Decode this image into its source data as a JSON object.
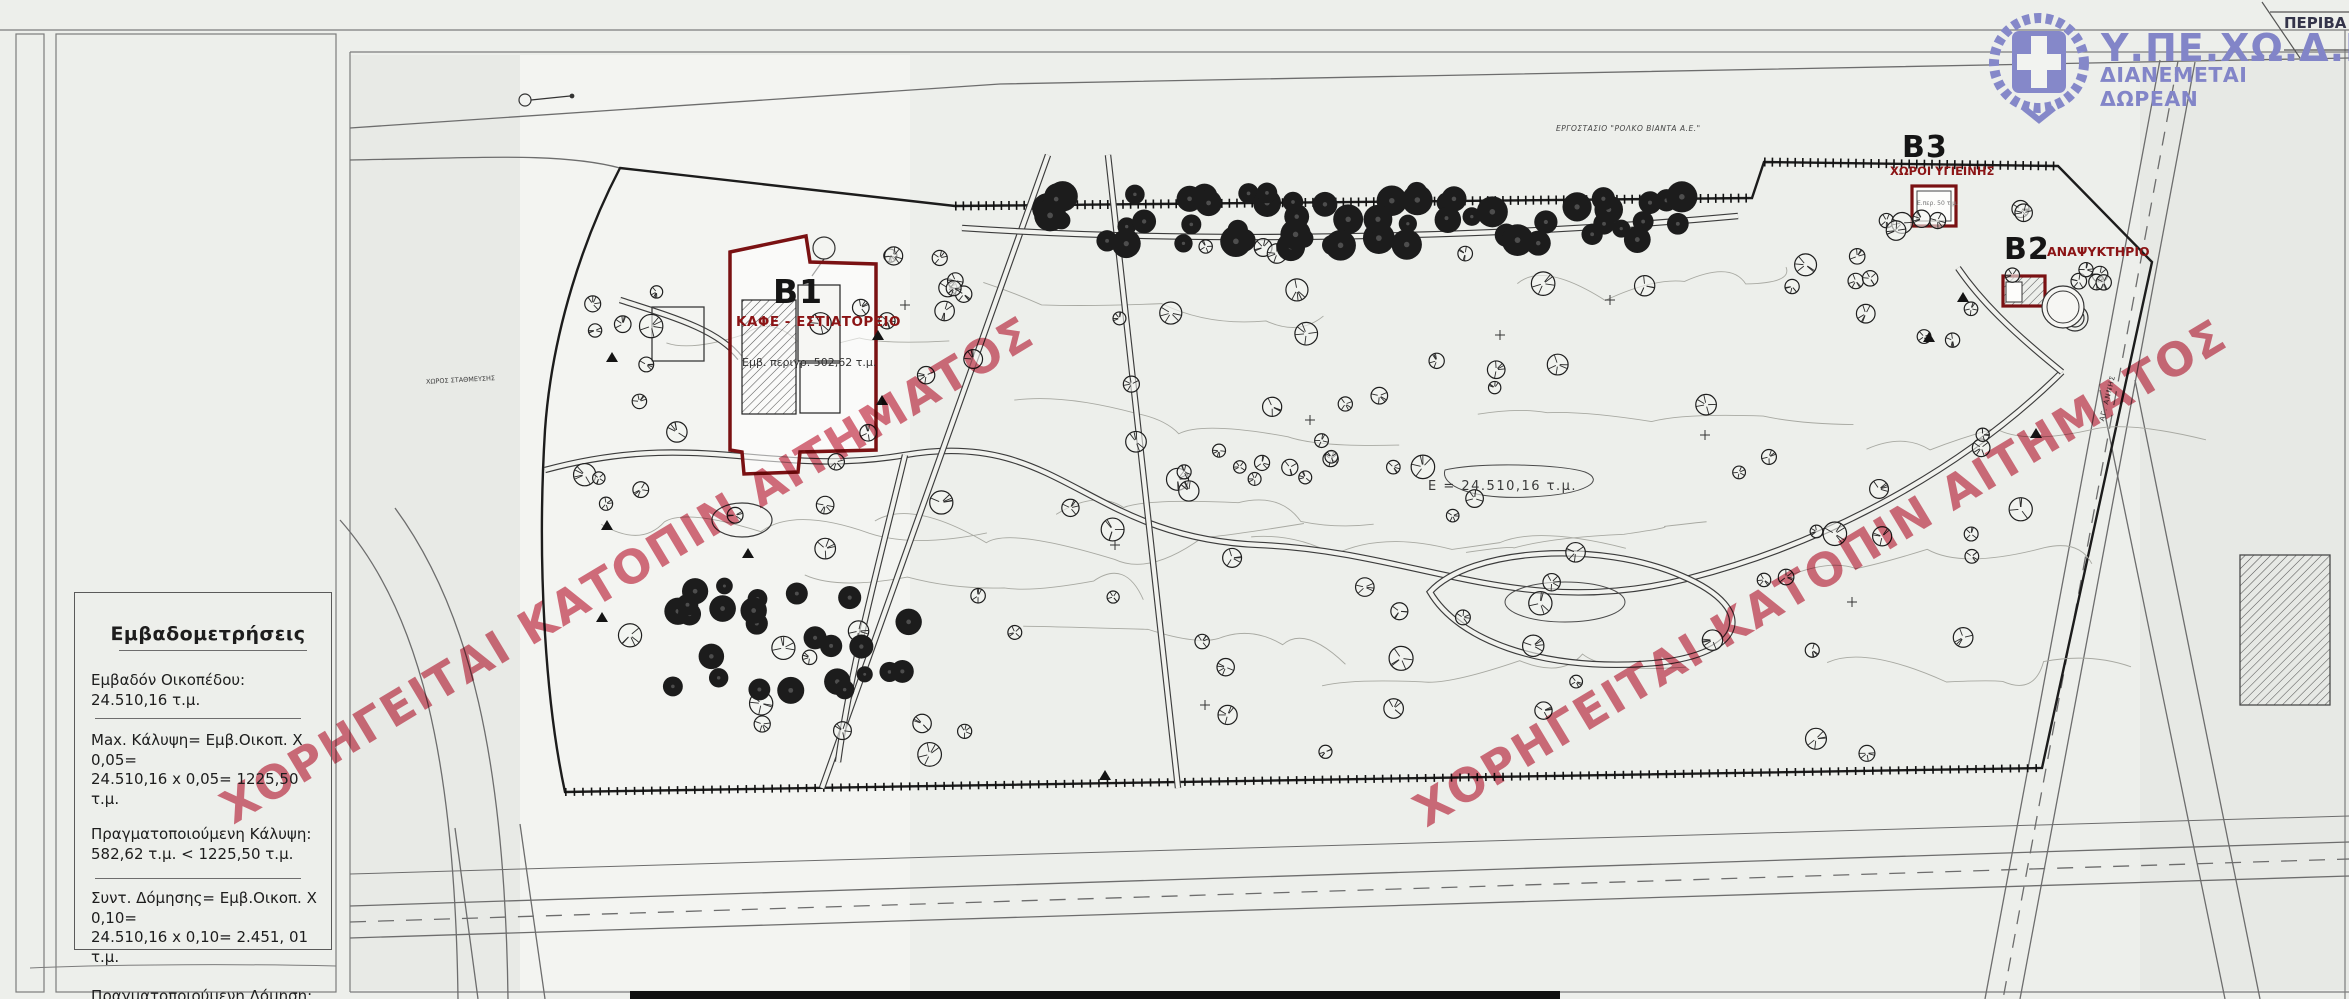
{
  "header": {
    "agency": "Υ.ΠΕ.ΧΩ.Δ.Ε.",
    "distribution": "ΔΙΑΝΕΜΕΤΑΙ ΔΩΡΕΑΝ",
    "corner_label": "ΠΕΡΙΒΑ",
    "emblem_icon": "greek-cross-wreath-emblem",
    "brand_color": "#8285c8"
  },
  "watermark": {
    "text": "ΧΟΡΗΓΕΙΤΑΙ ΚΑΤΟΠΙΝ ΑΙΤΗΜΑΤΟΣ",
    "color": "#c0102c"
  },
  "map": {
    "site_area_label": "Ε = 24.510,16 τ.μ.",
    "factory_label": "ΕΡΓΟΣΤΑΣΙΟ \"ΡΟΛΚΟ ΒΙΑΝΤΑ Α.Ε.\"",
    "parking_label": "ΧΩΡΟΣ ΣΤΑΘΜΕΥΣΗΣ",
    "road_label": "ΑΓ. ΑΝΝΗΣ",
    "accent_color": "#8b1415",
    "buildings": [
      {
        "code": "B1",
        "name": "ΚΑΦΕ - ΕΣΤΙΑΤΟΡΕΙΟ",
        "area": "Εμβ. περιγρ. 502,62 τ.μ."
      },
      {
        "code": "B2",
        "name": "ΑΝΑΨΥΚΤΗΡΙΟ"
      },
      {
        "code": "B3",
        "name": "ΧΩΡΟΙ ΥΓΙΕΙΝΗΣ",
        "area": "Ε.περ. 50 τ.μ."
      }
    ]
  },
  "panel": {
    "title": "Εμβαδομετρήσεις",
    "entries": [
      {
        "lines": [
          "Εμβαδόν Οικοπέδου: 24.510,16 τ.μ."
        ]
      },
      {
        "lines": [
          "Max. Κάλυψη= Εμβ.Οικοπ. Χ 0,05=",
          "24.510,16 x 0,05= 1225,50 τ.μ."
        ]
      },
      {
        "lines": [
          "Πραγματοποιούμενη Κάλυψη:",
          "582,62 τ.μ. < 1225,50 τ.μ."
        ]
      },
      {
        "lines": [
          "Συντ. Δόμησης= Εμβ.Οικοπ. Χ 0,10=",
          "24.510,16 x 0,10= 2.451, 01 τ.μ."
        ]
      },
      {
        "lines": [
          "Πραγματοποιούμενη Δόμηση:",
          "670,12 τ.μ. < 2.451,01 τ.μ."
        ]
      }
    ]
  }
}
